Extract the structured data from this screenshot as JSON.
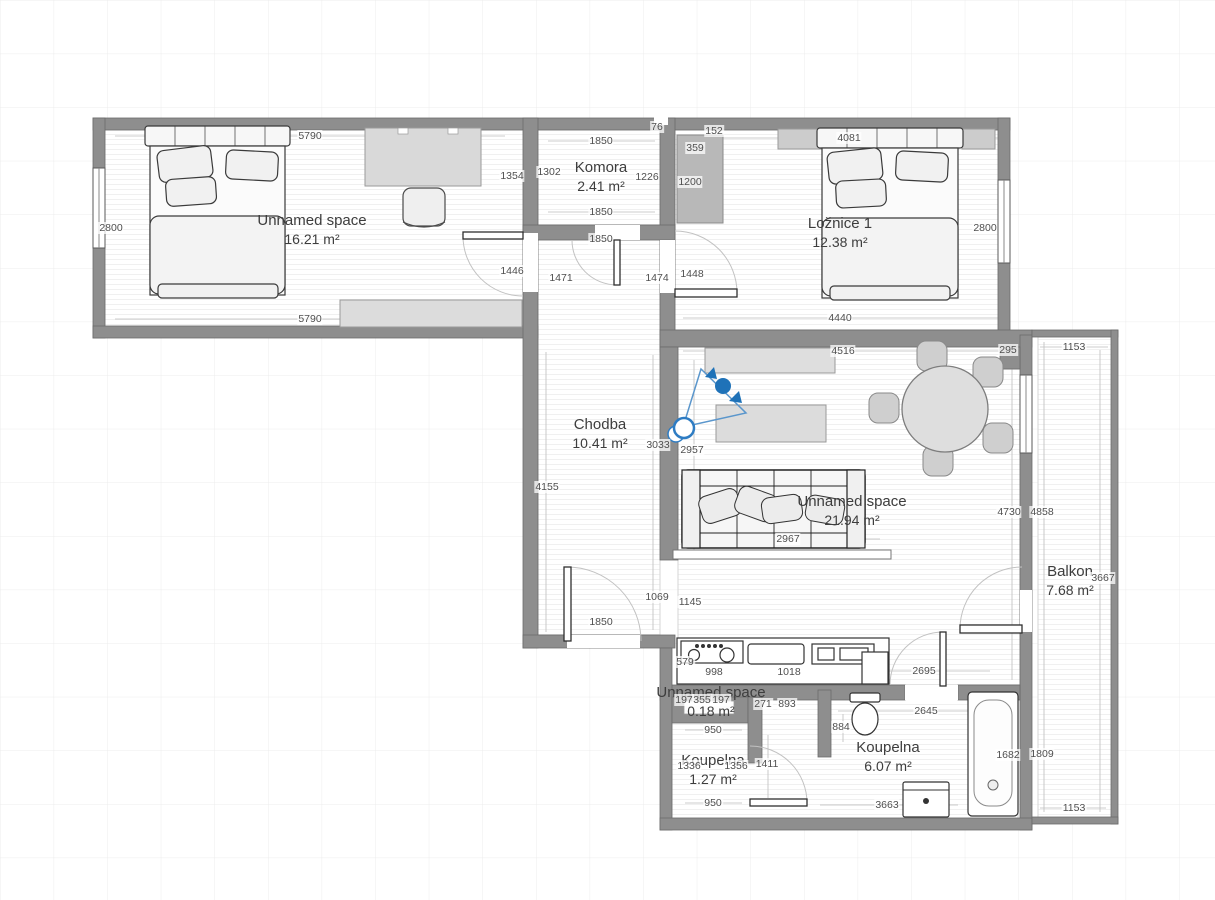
{
  "canvas": {
    "width": 1215,
    "height": 900,
    "background": "#ffffff",
    "grid_color": "#ececec",
    "wall_color": "#8e8e8e",
    "accent_blue": "#1f72b8",
    "dim_text_color": "#4f4f4f",
    "room_text_color": "#3d3d3d"
  },
  "rooms": [
    {
      "name": "Unnamed space",
      "area": "16.21 m²",
      "x": 312,
      "y": 230
    },
    {
      "name": "Komora",
      "area": "2.41 m²",
      "x": 601,
      "y": 177
    },
    {
      "name": "Ložnice 1",
      "area": "12.38 m²",
      "x": 840,
      "y": 233
    },
    {
      "name": "Chodba",
      "area": "10.41 m²",
      "x": 600,
      "y": 434
    },
    {
      "name": "Unnamed space",
      "area": "21.94 m²",
      "x": 852,
      "y": 511
    },
    {
      "name": "Balkon",
      "area": "7.68 m²",
      "x": 1070,
      "y": 581
    },
    {
      "name": "Unnamed space",
      "area": "0.18 m²",
      "x": 711,
      "y": 702
    },
    {
      "name": "Koupelna",
      "area": "1.27 m²",
      "x": 713,
      "y": 770
    },
    {
      "name": "Koupelna",
      "area": "6.07 m²",
      "x": 888,
      "y": 757
    }
  ],
  "dimensions": [
    {
      "t": "5790",
      "x": 310,
      "y": 136
    },
    {
      "t": "2800",
      "x": 111,
      "y": 228
    },
    {
      "t": "1354",
      "x": 512,
      "y": 176
    },
    {
      "t": "1446",
      "x": 512,
      "y": 271
    },
    {
      "t": "5790",
      "x": 310,
      "y": 319
    },
    {
      "t": "1302",
      "x": 549,
      "y": 172
    },
    {
      "t": "1850",
      "x": 601,
      "y": 141
    },
    {
      "t": "76",
      "x": 657,
      "y": 127
    },
    {
      "t": "1226",
      "x": 647,
      "y": 177
    },
    {
      "t": "1850",
      "x": 601,
      "y": 212
    },
    {
      "t": "1850",
      "x": 601,
      "y": 239
    },
    {
      "t": "1471",
      "x": 561,
      "y": 278
    },
    {
      "t": "1474",
      "x": 657,
      "y": 278
    },
    {
      "t": "1448",
      "x": 692,
      "y": 274
    },
    {
      "t": "152",
      "x": 714,
      "y": 131
    },
    {
      "t": "359",
      "x": 695,
      "y": 148
    },
    {
      "t": "1200",
      "x": 690,
      "y": 182
    },
    {
      "t": "4081",
      "x": 849,
      "y": 138
    },
    {
      "t": "2800",
      "x": 985,
      "y": 228
    },
    {
      "t": "4440",
      "x": 840,
      "y": 318
    },
    {
      "t": "4516",
      "x": 843,
      "y": 351
    },
    {
      "t": "295",
      "x": 1008,
      "y": 350
    },
    {
      "t": "1153",
      "x": 1074,
      "y": 347
    },
    {
      "t": "3033",
      "x": 658,
      "y": 445
    },
    {
      "t": "2957",
      "x": 692,
      "y": 450
    },
    {
      "t": "4155",
      "x": 547,
      "y": 487
    },
    {
      "t": "2967",
      "x": 788,
      "y": 539
    },
    {
      "t": "4730",
      "x": 1009,
      "y": 512
    },
    {
      "t": "4858",
      "x": 1042,
      "y": 512
    },
    {
      "t": "3667",
      "x": 1103,
      "y": 578
    },
    {
      "t": "1069",
      "x": 657,
      "y": 597
    },
    {
      "t": "1145",
      "x": 690,
      "y": 602
    },
    {
      "t": "1850",
      "x": 601,
      "y": 622
    },
    {
      "t": "579",
      "x": 685,
      "y": 662
    },
    {
      "t": "998",
      "x": 714,
      "y": 672
    },
    {
      "t": "1018",
      "x": 789,
      "y": 672
    },
    {
      "t": "2695",
      "x": 924,
      "y": 671
    },
    {
      "t": "2645",
      "x": 926,
      "y": 711
    },
    {
      "t": "884",
      "x": 841,
      "y": 727
    },
    {
      "t": "271",
      "x": 763,
      "y": 704
    },
    {
      "t": "893",
      "x": 787,
      "y": 704
    },
    {
      "t": "197",
      "x": 684,
      "y": 700
    },
    {
      "t": "355",
      "x": 702,
      "y": 700
    },
    {
      "t": "197",
      "x": 721,
      "y": 700
    },
    {
      "t": "950",
      "x": 713,
      "y": 730
    },
    {
      "t": "1336",
      "x": 689,
      "y": 766
    },
    {
      "t": "1356",
      "x": 736,
      "y": 766
    },
    {
      "t": "1411",
      "x": 767,
      "y": 764
    },
    {
      "t": "950",
      "x": 713,
      "y": 803
    },
    {
      "t": "1682",
      "x": 1008,
      "y": 755
    },
    {
      "t": "1809",
      "x": 1042,
      "y": 754
    },
    {
      "t": "3663",
      "x": 887,
      "y": 805
    },
    {
      "t": "1153",
      "x": 1074,
      "y": 808
    }
  ],
  "furniture_icons": [
    "double-bed",
    "desk",
    "desk-chair",
    "dresser",
    "wardrobe",
    "wall-shelf",
    "sideboard",
    "coffee-table",
    "dining-table",
    "dining-chair",
    "sofa",
    "sofa-shelf",
    "kitchen-counter",
    "stove",
    "sink",
    "kitchen-appliance",
    "kitchen-column",
    "toilet",
    "bathtub",
    "washing-machine",
    "camera-view-marker"
  ]
}
